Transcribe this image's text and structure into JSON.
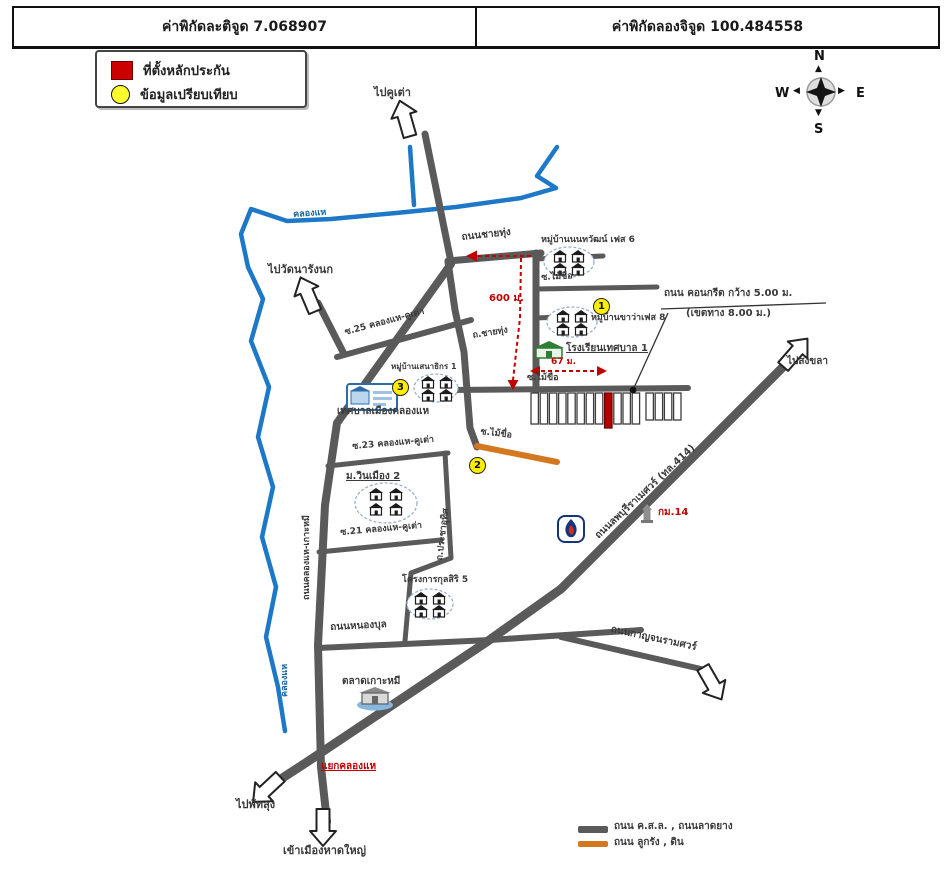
{
  "header": {
    "latitude": "ค่าพิกัดละติจูด 7.068907",
    "longitude": "ค่าพิกัดลองจิจูด 100.484558"
  },
  "legend": {
    "pledge_site": "ที่ตั้งหลักประกัน",
    "comparable": "ข้อมูลเปรียบเทียบ"
  },
  "compass": {
    "n": "N",
    "s": "S",
    "e": "E",
    "w": "W"
  },
  "labels": {
    "to_khu_tao": "ไปคูเต่า",
    "canal_khlong_hae": "คลองแห",
    "canal_khlong_hae_2": "คลองแห",
    "to_wat_na_rang_nok": "ไปวัดนารังนก",
    "road_chai_thung": "ถนนชายทุ่ง",
    "road_chai_thung_abbr": "ถ.ชายทุ่ง",
    "village_phase6": "หมู่บ้านนนทวัฒน์ เฟส 6",
    "village_phase8": "หมู่บ้านขาว่าเฟส 8",
    "soi_mai_khue": "ซ.ไม้ขื่อ",
    "dist_600m": "600 ม.",
    "dist_67m": "67 ม.",
    "school": "โรงเรียนเทศบาล 1",
    "concrete_road_1": "ถนน คอนกรีต กว้าง 5.00 ม.",
    "concrete_road_2": "(เขตทาง 8.00 ม.)",
    "to_songkhla": "ไปสงขลา",
    "road_414": "ถนนลพบุรีราเมศวร์ (ทล.414)",
    "km_14": "กม.14",
    "soi_25": "ซ.25 คลองแห-คูเต่า",
    "village_senathikon": "หมู่บ้านเสนาธิกร 1",
    "municipality": "เทศบาลเมืองคลองแห",
    "soi_23": "ซ.23 คลองแห-คูเต่า",
    "village_winmueang": "ม.วินเมือง 2",
    "soi_21": "ซ.21 คลองแห-คูเต่า",
    "road_prachauthit": "ถ.ประชาอุทิศ",
    "project_kulsiri": "โครงการกุลสิริ 5",
    "road_nongbul": "ถนนหนองบุล",
    "road_kanchana": "ถนนกาญจนรามศวร์",
    "market_komi": "ตลาดเกาะหมี",
    "road_khlonghae_komi": "ถนนคลองแห-เกาะหมี",
    "junction_khlonghae": "แยกคลองแห",
    "to_phatthalung": "ไปพัทลุง",
    "to_hatyai": "เข้าเมืองหาดใหญ่"
  },
  "markers": {
    "m1": "1",
    "m2": "2",
    "m3": "3"
  },
  "road_legend": {
    "paved": "ถนน ค.ส.ล. , ถนนลาดยาง",
    "unpaved": "ถนน ลูกรัง , ดิน"
  },
  "colors": {
    "road": "#5a5a5a",
    "canal": "#1e78c8",
    "unpaved": "#d4781f",
    "highlight_red": "#c00000",
    "marker_yellow": "#ffee00"
  }
}
